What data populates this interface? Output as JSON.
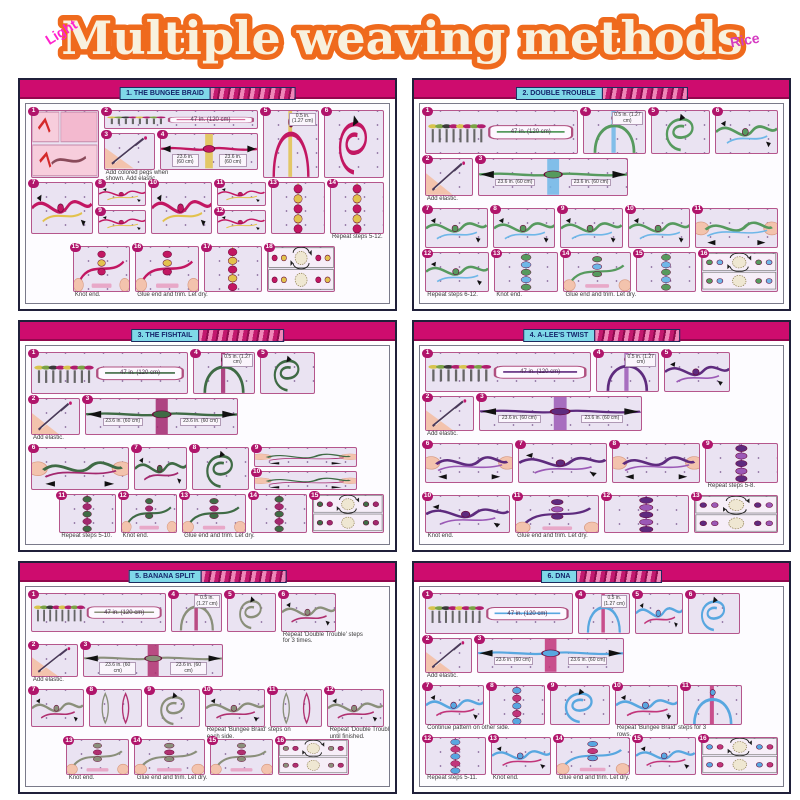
{
  "header": {
    "title": "Multiple weaving methods",
    "watermark_left": "Light",
    "watermark_right": "Rice"
  },
  "colors": {
    "title_outline_orange": "#ef6a1d",
    "title_fill_cream": "#f8f1de",
    "watermark_pink": "#ff22cc",
    "panel_bar_pink": "#ce0c6e",
    "banner_cyan": "#7fd8e8",
    "badge_magenta": "#b0156b",
    "step_bg_lavender": "#eae3f2"
  },
  "panels": [
    {
      "title": "1. THE BUNGEE BRAID",
      "c1": "#c21762",
      "c2": "#e2c24d",
      "rows": [
        {
          "h": 86,
          "cells": [
            {
              "k": "photo",
              "n": "1",
              "w": 17
            },
            {
              "w": 40,
              "rows": [
                {
                  "h": 30,
                  "cells": [
                    {
                      "k": "pegs",
                      "n": "2",
                      "w": 100,
                      "lbl": "47 in. (120 cm)"
                    }
                  ]
                },
                {
                  "h": 56,
                  "cells": [
                    {
                      "k": "elastic",
                      "n": "3",
                      "w": 34,
                      "cap": "Add colored pegs when shown. Add elastic."
                    },
                    {
                      "k": "spread",
                      "n": "4",
                      "w": 66,
                      "lbl": "23.6 in. (60 cm)"
                    }
                  ]
                }
              ]
            },
            {
              "k": "arch",
              "n": "5",
              "w": 14,
              "lbl": "0.5 in. (1.27 cm)"
            },
            {
              "k": "loop",
              "n": "6",
              "w": 15
            }
          ]
        },
        {
          "h": 66,
          "cells": [
            {
              "k": "knot",
              "n": "7",
              "w": 16
            },
            {
              "w": 13,
              "rows": [
                {
                  "h": 1,
                  "cells": [
                    {
                      "k": "knot",
                      "n": "8",
                      "w": 100
                    }
                  ]
                },
                {
                  "h": 1,
                  "cells": [
                    {
                      "k": "knot",
                      "n": "9",
                      "w": 100
                    }
                  ]
                }
              ]
            },
            {
              "k": "knot",
              "n": "10",
              "w": 16
            },
            {
              "w": 13,
              "rows": [
                {
                  "h": 1,
                  "cells": [
                    {
                      "k": "knot",
                      "n": "11",
                      "w": 100
                    }
                  ]
                },
                {
                  "h": 1,
                  "cells": [
                    {
                      "k": "knot",
                      "n": "12",
                      "w": 100
                    }
                  ]
                }
              ]
            },
            {
              "k": "braid",
              "n": "13",
              "w": 14
            },
            {
              "k": "braid",
              "n": "14",
              "w": 14,
              "cap": "Repeat steps 5-12."
            }
          ]
        },
        {
          "h": 58,
          "cells": [
            {
              "k": "pad",
              "w": 10
            },
            {
              "k": "hands",
              "n": "15",
              "w": 15,
              "cap": "Knot end."
            },
            {
              "k": "hands",
              "n": "16",
              "w": 17,
              "cap": "Glue end and trim. Let dry."
            },
            {
              "k": "braid",
              "n": "17",
              "w": 15
            },
            {
              "k": "finished",
              "n": "18",
              "w": 18
            },
            {
              "k": "pad",
              "w": 12
            }
          ]
        }
      ]
    },
    {
      "title": "2. DOUBLE TROUBLE",
      "c1": "#569a5e",
      "c2": "#6fb7e8",
      "rows": [
        {
          "h": 58,
          "cells": [
            {
              "k": "pegs",
              "n": "1",
              "w": 42,
              "lbl": "47 in. (120 cm)"
            },
            {
              "k": "arch",
              "n": "4",
              "w": 17,
              "lbl": "0.5 in. (1.27 cm)"
            },
            {
              "k": "loop",
              "n": "5",
              "w": 16
            },
            {
              "k": "knot",
              "n": "6",
              "w": 17
            }
          ]
        },
        {
          "h": 50,
          "cells": [
            {
              "k": "elastic",
              "n": "2",
              "w": 13,
              "cap": "Add elastic."
            },
            {
              "k": "spread",
              "n": "3",
              "w": 42,
              "lbl": "23.6 in. (60 cm)"
            },
            {
              "k": "pad",
              "w": 41
            }
          ]
        },
        {
          "h": 54,
          "cells": [
            {
              "k": "knot",
              "n": "7",
              "w": 15
            },
            {
              "k": "knot",
              "n": "8",
              "w": 15
            },
            {
              "k": "knot",
              "n": "9",
              "w": 15
            },
            {
              "k": "knot",
              "n": "10",
              "w": 15
            },
            {
              "k": "pull",
              "n": "11",
              "w": 20
            }
          ]
        },
        {
          "h": 52,
          "cells": [
            {
              "k": "knot",
              "n": "12",
              "w": 15,
              "cap": "Repeat steps 6-12."
            },
            {
              "k": "braid",
              "n": "13",
              "w": 15,
              "cap": "Knot end."
            },
            {
              "k": "hands",
              "n": "14",
              "w": 16,
              "cap": "Glue end and trim. Let dry."
            },
            {
              "k": "braid",
              "n": "15",
              "w": 14
            },
            {
              "k": "finished",
              "n": "16",
              "w": 18
            }
          ]
        }
      ]
    },
    {
      "title": "3. THE FISHTAIL",
      "c1": "#3f6b45",
      "c2": "#a3286e",
      "rows": [
        {
          "h": 56,
          "cells": [
            {
              "k": "pegs",
              "n": "1",
              "w": 44,
              "lbl": "47 in. (120 cm)"
            },
            {
              "k": "arch",
              "n": "4",
              "w": 17,
              "lbl": "0.5 in. (1.27 cm)"
            },
            {
              "k": "loop",
              "n": "5",
              "w": 15
            },
            {
              "k": "pad",
              "w": 18
            }
          ]
        },
        {
          "h": 50,
          "cells": [
            {
              "k": "elastic",
              "n": "2",
              "w": 13,
              "cap": "Add elastic."
            },
            {
              "k": "spread",
              "n": "3",
              "w": 42,
              "lbl": "23.6 in. (60 cm)"
            },
            {
              "k": "pad",
              "w": 39
            }
          ]
        },
        {
          "h": 58,
          "cells": [
            {
              "k": "pull",
              "n": "6",
              "w": 26
            },
            {
              "k": "knot",
              "n": "7",
              "w": 14
            },
            {
              "k": "loop",
              "n": "8",
              "w": 15
            },
            {
              "w": 28,
              "rows": [
                {
                  "h": 1,
                  "cells": [
                    {
                      "k": "pull",
                      "n": "9",
                      "w": 100
                    }
                  ]
                },
                {
                  "h": 1,
                  "cells": [
                    {
                      "k": "pull",
                      "n": "10",
                      "w": 100
                    }
                  ]
                }
              ]
            },
            {
              "k": "pad",
              "w": 6
            }
          ]
        },
        {
          "h": 52,
          "cells": [
            {
              "k": "pad",
              "w": 6
            },
            {
              "k": "braid",
              "n": "11",
              "w": 14,
              "cap": "Repeat steps 5-10."
            },
            {
              "k": "hands",
              "n": "12",
              "w": 14,
              "cap": "Knot end."
            },
            {
              "k": "hands",
              "n": "13",
              "w": 16,
              "cap": "Glue end and trim. Let dry."
            },
            {
              "k": "braid",
              "n": "14",
              "w": 14
            },
            {
              "k": "finished",
              "n": "15",
              "w": 18
            }
          ]
        }
      ]
    },
    {
      "title": "4. A-LEE'S TWIST",
      "c1": "#5e2b7e",
      "c2": "#9b59b6",
      "rows": [
        {
          "h": 56,
          "cells": [
            {
              "k": "pegs",
              "n": "1",
              "w": 46,
              "lbl": "47 in. (120 cm)"
            },
            {
              "k": "arch",
              "n": "4",
              "w": 17,
              "lbl": "0.5 in. (1.27 cm)"
            },
            {
              "k": "knot",
              "n": "5",
              "w": 18
            },
            {
              "k": "pad",
              "w": 12
            }
          ]
        },
        {
          "h": 50,
          "cells": [
            {
              "k": "elastic",
              "n": "2",
              "w": 13,
              "cap": "Add elastic."
            },
            {
              "k": "spread",
              "n": "3",
              "w": 44,
              "lbl": "23.6 in. (60 cm)"
            },
            {
              "k": "pad",
              "w": 36
            }
          ]
        },
        {
          "h": 56,
          "cells": [
            {
              "k": "pull",
              "n": "6",
              "w": 22
            },
            {
              "k": "knot",
              "n": "7",
              "w": 22
            },
            {
              "k": "pull",
              "n": "8",
              "w": 22
            },
            {
              "k": "braid",
              "n": "9",
              "w": 18,
              "cap": "Repeat steps 5-8."
            }
          ]
        },
        {
          "h": 54,
          "cells": [
            {
              "k": "knot",
              "n": "10",
              "w": 20,
              "cap": "Knot end."
            },
            {
              "k": "hands",
              "n": "11",
              "w": 20,
              "cap": "Glue end and trim. Let dry."
            },
            {
              "k": "braid",
              "n": "12",
              "w": 20
            },
            {
              "k": "finished",
              "n": "13",
              "w": 20
            }
          ]
        }
      ]
    },
    {
      "title": "5. BANANA SPLIT",
      "c1": "#8a8f7a",
      "c2": "#b03070",
      "rows": [
        {
          "h": 56,
          "cells": [
            {
              "k": "pegs",
              "n": "1",
              "w": 40,
              "lbl": "47 in. (120 cm)"
            },
            {
              "k": "arch",
              "n": "4",
              "w": 15,
              "lbl": "0.5 in. (1.27 cm)"
            },
            {
              "k": "loop",
              "n": "5",
              "w": 14
            },
            {
              "k": "knot",
              "n": "6",
              "w": 16,
              "cap": "Repeat 'Double Trouble' steps for 3 times."
            },
            {
              "k": "pad",
              "w": 13
            }
          ]
        },
        {
          "h": 48,
          "cells": [
            {
              "k": "elastic",
              "n": "2",
              "w": 13,
              "cap": "Add elastic."
            },
            {
              "k": "spread",
              "n": "3",
              "w": 40,
              "lbl": "23.6 in. (60 cm)"
            },
            {
              "k": "pad",
              "w": 45
            }
          ]
        },
        {
          "h": 56,
          "cells": [
            {
              "k": "knot",
              "n": "7",
              "w": 14
            },
            {
              "k": "twin",
              "n": "8",
              "w": 14
            },
            {
              "k": "loop",
              "n": "9",
              "w": 14
            },
            {
              "k": "knot",
              "n": "10",
              "w": 16,
              "cap": "Repeat 'Bungee Braid' steps on each side."
            },
            {
              "k": "twin",
              "n": "11",
              "w": 14
            },
            {
              "k": "knot",
              "n": "12",
              "w": 15,
              "cap": "Repeat 'Double Trouble' steps until finished."
            }
          ]
        },
        {
          "h": 52,
          "cells": [
            {
              "k": "pad",
              "w": 8
            },
            {
              "k": "hands",
              "n": "13",
              "w": 16,
              "cap": "Knot end."
            },
            {
              "k": "hands",
              "n": "14",
              "w": 18,
              "cap": "Glue end and trim. Let dry."
            },
            {
              "k": "hands",
              "n": "15",
              "w": 16
            },
            {
              "k": "finished",
              "n": "16",
              "w": 18
            },
            {
              "k": "pad",
              "w": 8
            }
          ]
        }
      ]
    },
    {
      "title": "6. DNA",
      "c1": "#58a7e0",
      "c2": "#c2357a",
      "rows": [
        {
          "h": 56,
          "cells": [
            {
              "k": "pegs",
              "n": "1",
              "w": 44,
              "lbl": "47 in. (120 cm)"
            },
            {
              "k": "arch",
              "n": "4",
              "w": 15,
              "lbl": "0.5 in. (1.27 cm)"
            },
            {
              "k": "knot",
              "n": "5",
              "w": 14
            },
            {
              "k": "loop",
              "n": "6",
              "w": 15
            },
            {
              "k": "pad",
              "w": 10
            }
          ]
        },
        {
          "h": 48,
          "cells": [
            {
              "k": "elastic",
              "n": "2",
              "w": 13,
              "cap": "Add elastic."
            },
            {
              "k": "spread",
              "n": "3",
              "w": 42,
              "lbl": "23.6 in. (60 cm)"
            },
            {
              "k": "pad",
              "w": 43
            }
          ]
        },
        {
          "h": 56,
          "cells": [
            {
              "k": "knot",
              "n": "7",
              "w": 15,
              "cap": "Continue pattern on other side."
            },
            {
              "k": "braid",
              "n": "8",
              "w": 14
            },
            {
              "k": "loop",
              "n": "9",
              "w": 15
            },
            {
              "k": "knot",
              "n": "10",
              "w": 16,
              "cap": "Repeat 'Bungee Braid' steps for 3 rows."
            },
            {
              "k": "arch",
              "n": "11",
              "w": 15
            },
            {
              "k": "pad",
              "w": 8
            }
          ]
        },
        {
          "h": 52,
          "cells": [
            {
              "k": "braid",
              "n": "12",
              "w": 14,
              "cap": "Repeat steps 5-11."
            },
            {
              "k": "knot",
              "n": "13",
              "w": 14,
              "cap": "Knot end."
            },
            {
              "k": "hands",
              "n": "14",
              "w": 17,
              "cap": "Glue end and trim. Let dry."
            },
            {
              "k": "knot",
              "n": "15",
              "w": 14
            },
            {
              "k": "finished",
              "n": "16",
              "w": 18
            }
          ]
        }
      ]
    }
  ]
}
